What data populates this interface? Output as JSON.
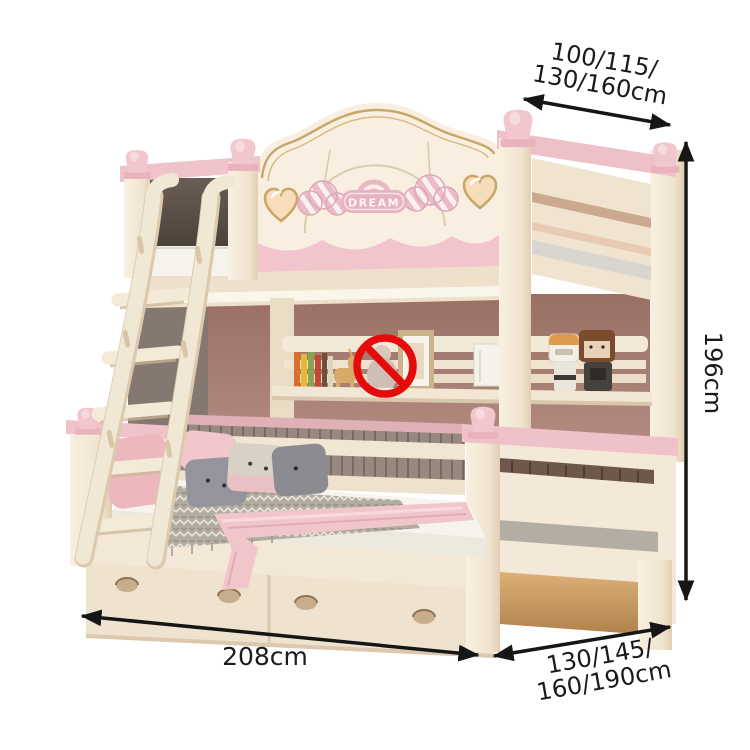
{
  "annotations": {
    "arrow_color": "#161616",
    "top_width": {
      "line1": "100/115/",
      "line2": "130/160cm"
    },
    "height": "196cm",
    "length": "208cm",
    "depth": {
      "line1": "130/145/",
      "line2": "160/190cm"
    }
  },
  "product": {
    "badge_text": "DREAM",
    "colors": {
      "cream": "#f3e8d7",
      "cream_shadow": "#ddc9ac",
      "pink_accent": "#f0c3ca",
      "pink_dark": "#e3a8b4",
      "mauve_back_panel": "#a97e74",
      "backrest_taupe": "#97897f",
      "gold_trim": "#c9a567",
      "prohibition_red": "#e60b0b",
      "mattress_white": "#f6f3ee",
      "wood_floor": "#c89a63"
    }
  },
  "icons": {
    "prohibition": "red-circle-with-slash",
    "arrows": "double-headed-dimension-arrow"
  }
}
